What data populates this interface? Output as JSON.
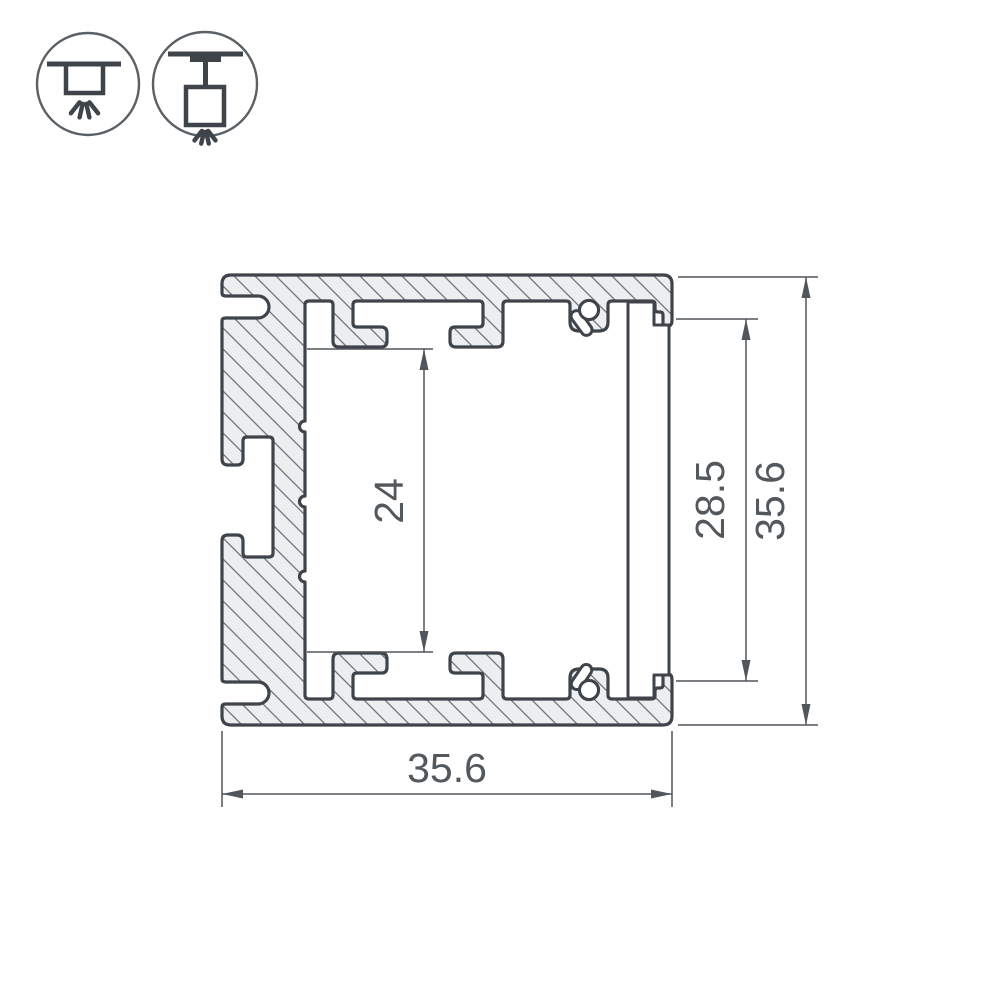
{
  "drawing": {
    "title": "aluminium-profile-cross-section",
    "dimensions": {
      "inner_height": "24",
      "opening_height": "28.5",
      "overall_height": "35.6",
      "overall_width": "35.6"
    },
    "icons": [
      {
        "name": "recessed-mount-icon"
      },
      {
        "name": "pendant-mount-icon"
      }
    ],
    "colors": {
      "outline": "#3e444a",
      "hatch_line": "#6e747a",
      "metal_fill": "#edeef0",
      "dimension_line": "#51565b",
      "background": "#ffffff"
    }
  }
}
